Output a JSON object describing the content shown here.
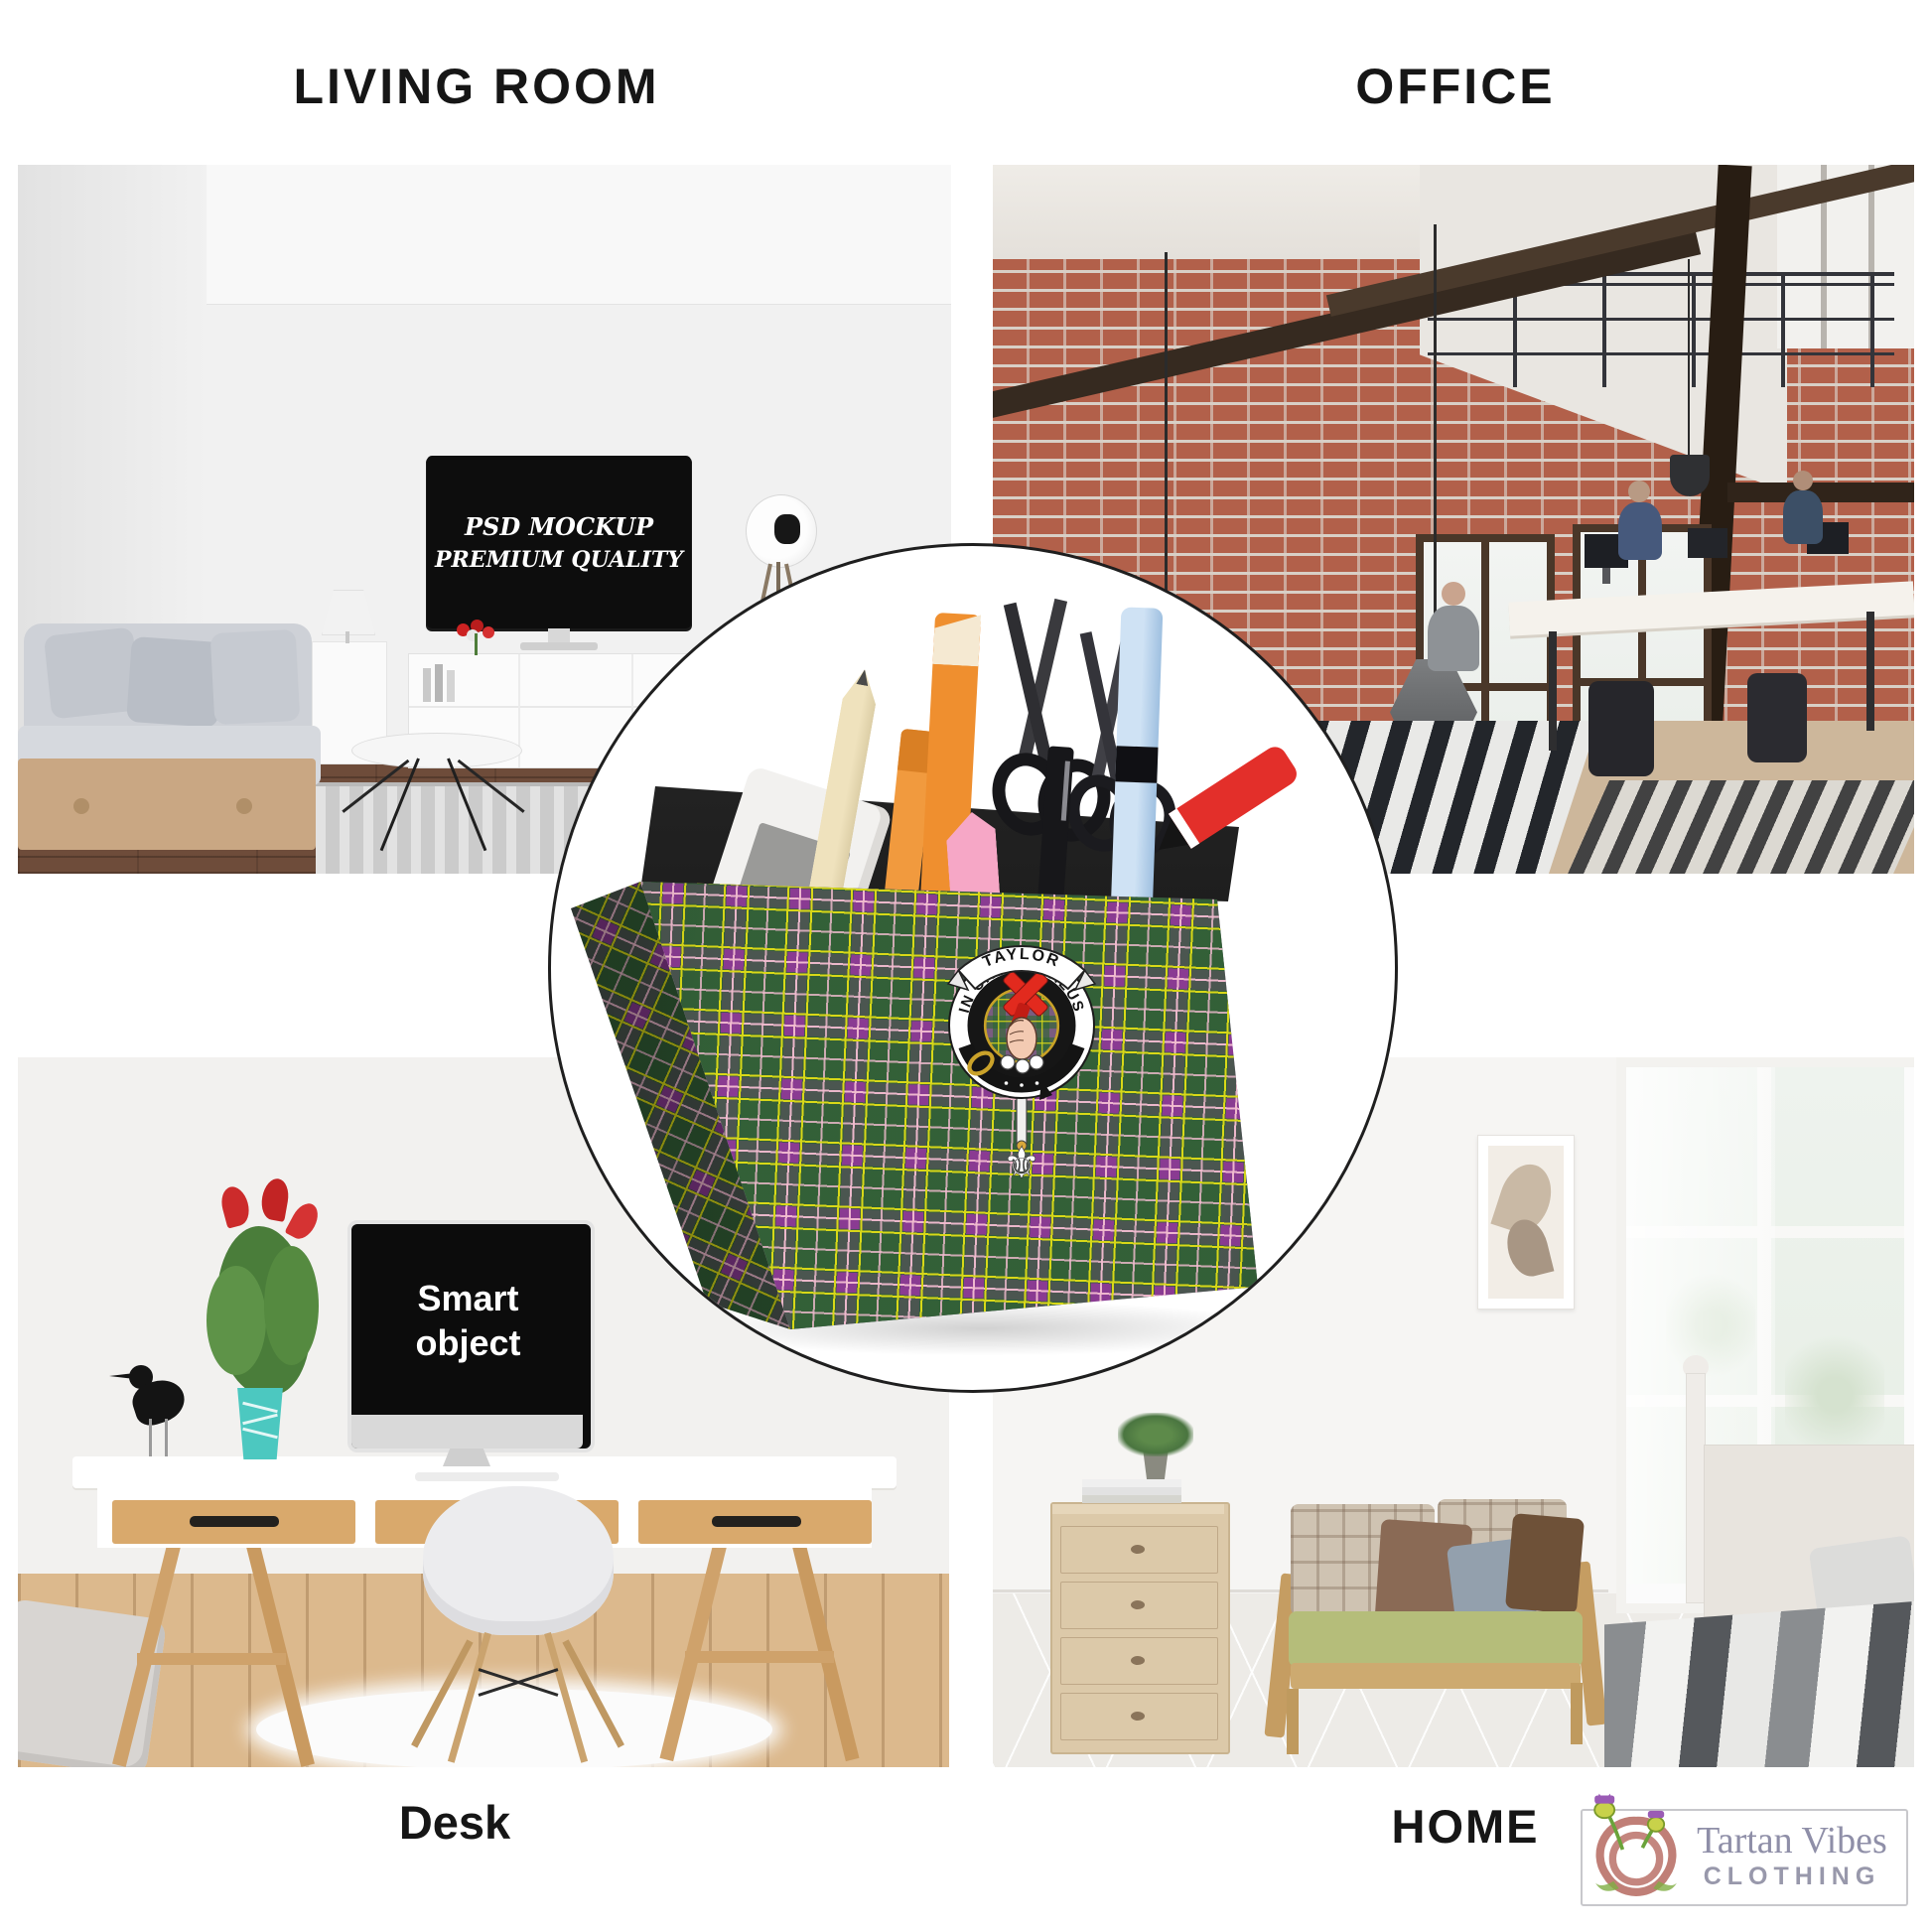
{
  "page": {
    "background": "#ffffff",
    "circle_border": "#1f1f1f"
  },
  "headings": {
    "living_room": "LIVING ROOM",
    "office": "OFFICE",
    "desk": "Desk",
    "home": "HOME"
  },
  "scenes": {
    "living_room": {
      "tv_line1": "PSD MOCKUP",
      "tv_line2": "PREMIUM QUALITY"
    },
    "desk": {
      "monitor_text": "Smart object"
    }
  },
  "product": {
    "crest_name": "TAYLOR",
    "crest_motto": "IN CRUCE SALUS",
    "tartan": {
      "purple": "#8a3b92",
      "green": "#2e6628",
      "yellow": "#d8d818",
      "pink": "#f2bcd0"
    }
  },
  "brand": {
    "name": "Tartan Vibes",
    "subtitle": "CLOTHING",
    "name_color": "#8f8fa8",
    "subtitle_color": "#9898ab"
  }
}
